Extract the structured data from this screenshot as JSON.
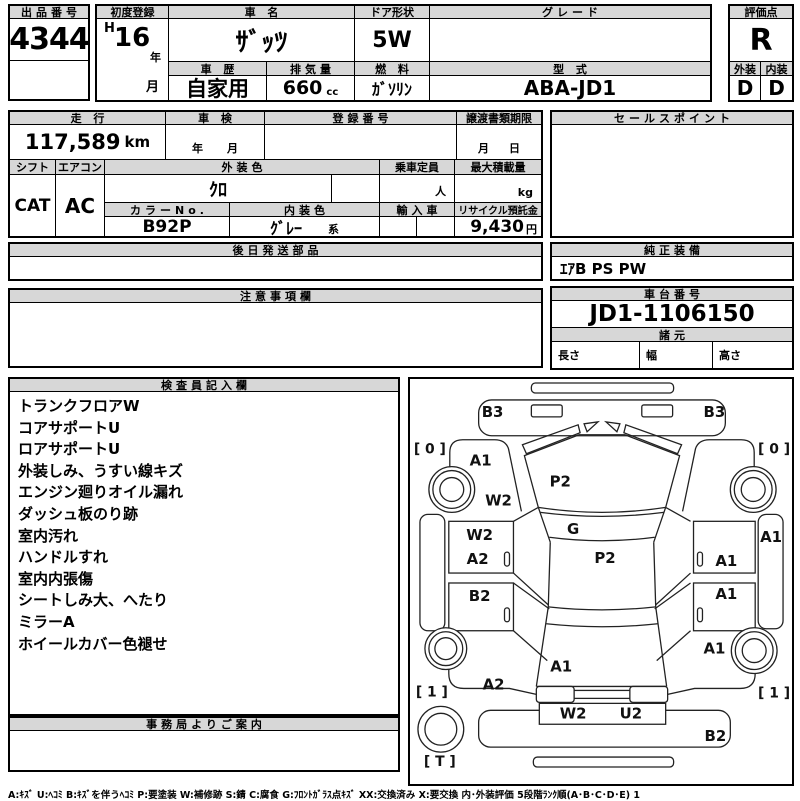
{
  "top": {
    "auction_no": {
      "label": "出品番号",
      "value": "4344"
    },
    "first_registration": {
      "label": "初度登録",
      "era": "H",
      "year": "16",
      "year_unit": "年",
      "month_unit": "月"
    },
    "car_name": {
      "label": "車 名",
      "value": "ｻﾞｯﾂ"
    },
    "door_shape": {
      "label": "ドア形状",
      "value": "5W"
    },
    "grade": {
      "label": "グレード",
      "value": ""
    },
    "car_history": {
      "label": "車 歴",
      "value": "自家用"
    },
    "displacement": {
      "label": "排気量",
      "value": "660",
      "unit": "cc"
    },
    "fuel": {
      "label": "燃 料",
      "value": "ｶﾞｿﾘﾝ"
    },
    "model_code": {
      "label": "型 式",
      "value": "ABA-JD1"
    },
    "score": {
      "label": "評価点",
      "value": "R"
    },
    "exterior_grade": {
      "label": "外装",
      "value": "D"
    },
    "interior_grade": {
      "label": "内装",
      "value": "D"
    }
  },
  "specs": {
    "mileage": {
      "label": "走 行",
      "value": "117,589",
      "unit": "km"
    },
    "shaken": {
      "label": "車 検",
      "year_unit": "年",
      "month_unit": "月"
    },
    "registration_no": {
      "label": "登録番号",
      "value": ""
    },
    "transfer_deadline": {
      "label": "譲渡書類期限",
      "month_unit": "月",
      "day_unit": "日"
    },
    "shift": {
      "label": "シフト",
      "value": "CAT"
    },
    "aircon": {
      "label": "エアコン",
      "value": "AC"
    },
    "exterior_color": {
      "label": "外装色",
      "value": "ｸﾛ"
    },
    "capacity": {
      "label": "乗車定員",
      "value": "",
      "unit": "人"
    },
    "max_load": {
      "label": "最大積載量",
      "value": "",
      "unit": "kg"
    },
    "color_no": {
      "label": "カラーNo.",
      "value": "B92P"
    },
    "interior_color": {
      "label": "内装色",
      "value": "ｸﾞﾚｰ",
      "suffix": "系"
    },
    "import_car": {
      "label": "輸入車",
      "value": ""
    },
    "recycle_fee": {
      "label": "リサイクル預託金",
      "value": "9,430",
      "unit": "円"
    },
    "sales_point": {
      "label": "セールスポイント",
      "value": ""
    }
  },
  "mid": {
    "later_parts": {
      "label": "後日発送部品",
      "value": ""
    },
    "genuine_equipment": {
      "label": "純正装備",
      "value": "ｴｱB PS PW"
    },
    "cautions": {
      "label": "注意事項欄",
      "value": ""
    },
    "chassis_no": {
      "label": "車台番号",
      "value": "JD1-1106150"
    },
    "dimensions": {
      "label": "諸元",
      "length_label": "長さ",
      "width_label": "幅",
      "height_label": "高さ",
      "length": "",
      "width": "",
      "height": ""
    }
  },
  "inspection": {
    "label": "検査員記入欄",
    "items": [
      "トランクフロアW",
      "コアサポートU",
      "ロアサポートU",
      "外装しみ、うすい線キズ",
      "エンジン廻りオイル漏れ",
      "ダッシュ板のり跡",
      "室内汚れ",
      "ハンドルすれ",
      "室内内張傷",
      "シートしみ大、へたり",
      "ミラーA",
      "ホイールカバー色褪せ"
    ]
  },
  "office": {
    "label": "事務局よりご案内",
    "value": ""
  },
  "diagram": {
    "marks": [
      {
        "code": "B3",
        "x": 83,
        "y": 38
      },
      {
        "code": "B3",
        "x": 306,
        "y": 38
      },
      {
        "code": "A1",
        "x": 71,
        "y": 87
      },
      {
        "code": "P2",
        "x": 151,
        "y": 108
      },
      {
        "code": "W2",
        "x": 89,
        "y": 127
      },
      {
        "code": "G",
        "x": 164,
        "y": 156
      },
      {
        "code": "P2",
        "x": 196,
        "y": 185
      },
      {
        "code": "W2",
        "x": 70,
        "y": 162
      },
      {
        "code": "A2",
        "x": 68,
        "y": 186
      },
      {
        "code": "B2",
        "x": 70,
        "y": 223
      },
      {
        "code": "A1",
        "x": 318,
        "y": 188
      },
      {
        "code": "A1",
        "x": 318,
        "y": 221
      },
      {
        "code": "A1",
        "x": 363,
        "y": 164
      },
      {
        "code": "A2",
        "x": 84,
        "y": 312
      },
      {
        "code": "A1",
        "x": 306,
        "y": 276
      },
      {
        "code": "A1",
        "x": 152,
        "y": 294
      },
      {
        "code": "W2",
        "x": 164,
        "y": 341
      },
      {
        "code": "U2",
        "x": 222,
        "y": 341
      },
      {
        "code": "B2",
        "x": 307,
        "y": 364
      }
    ],
    "corner_marks": [
      {
        "code": "[ 0 ]",
        "x": 20,
        "y": 75
      },
      {
        "code": "[ 0 ]",
        "x": 366,
        "y": 75
      },
      {
        "code": "[ 1 ]",
        "x": 22,
        "y": 319
      },
      {
        "code": "[ 1 ]",
        "x": 366,
        "y": 320
      },
      {
        "code": "[ T ]",
        "x": 30,
        "y": 389
      }
    ]
  },
  "footer": {
    "legend": "A:ｷｽﾞ  U:ﾍｺﾐ  B:ｷｽﾞを伴うﾍｺﾐ  P:要塗装  W:補修跡  S:錆  C:腐食  G:ﾌﾛﾝﾄｶﾞﾗｽ点ｷｽﾞ  XX:交換済み  X:要交換   内･外装評価   5段階ﾗﾝｸ順(A･B･C･D･E) 1"
  }
}
